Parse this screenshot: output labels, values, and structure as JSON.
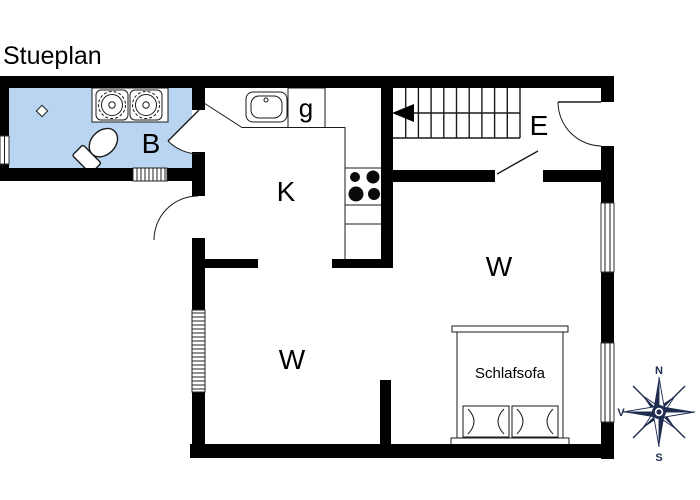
{
  "title": "Stueplan",
  "rooms": {
    "bathroom_label": "B",
    "kitchen_label": "K",
    "pantry_label": "g",
    "entry_label": "E",
    "living_upper_label": "W",
    "living_lower_label": "W"
  },
  "furniture": {
    "sofa_bed_label": "Schlafsofa"
  },
  "compass": {
    "north_label": "N",
    "south_label": "S",
    "west_label": "V"
  },
  "colors": {
    "bathroom_fill": "#b9d5f2",
    "wall": "#000000",
    "compass_navy": "#1e2c4f"
  }
}
